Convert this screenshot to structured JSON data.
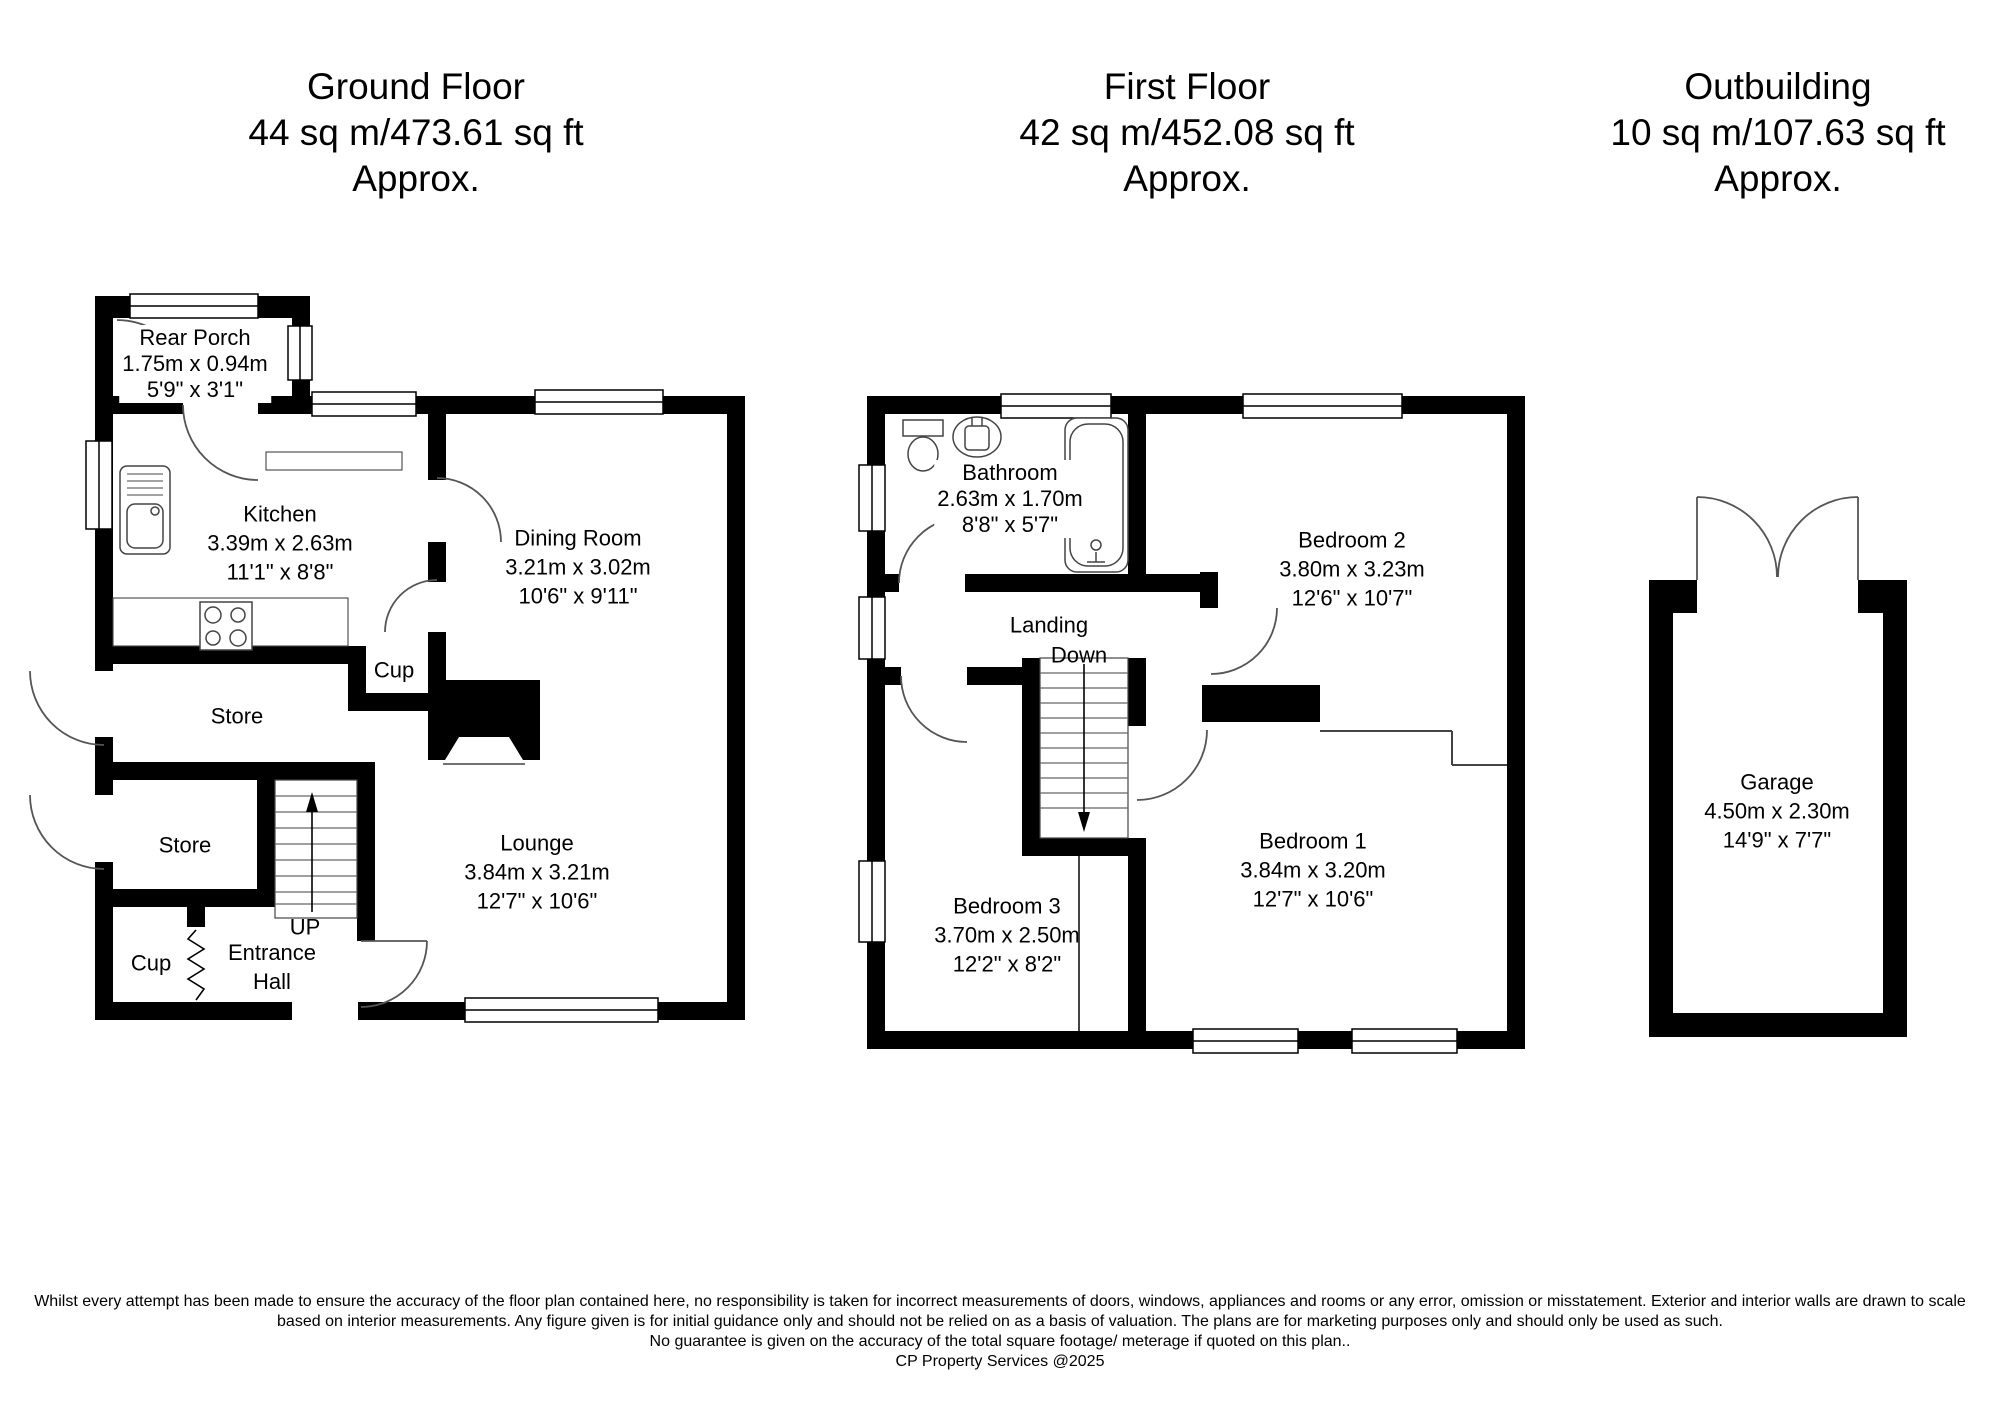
{
  "colors": {
    "background": "#ffffff",
    "wall": "#000000",
    "thin_line": "#444444",
    "text": "#000000"
  },
  "floors": [
    {
      "title": "Ground Floor",
      "area": "44 sq m/473.61 sq ft",
      "approx": "Approx.",
      "rooms": {
        "rear_porch": {
          "name": "Rear Porch",
          "metric": "1.75m x 0.94m",
          "imperial": "5'9\" x 3'1\""
        },
        "kitchen": {
          "name": "Kitchen",
          "metric": "3.39m x 2.63m",
          "imperial": "11'1\" x 8'8\""
        },
        "dining_room": {
          "name": "Dining Room",
          "metric": "3.21m x 3.02m",
          "imperial": "10'6\" x 9'11\""
        },
        "lounge": {
          "name": "Lounge",
          "metric": "3.84m x 3.21m",
          "imperial": "12'7\" x 10'6\""
        },
        "store_1": {
          "name": "Store"
        },
        "store_2": {
          "name": "Store"
        },
        "cup_upper": {
          "name": "Cup"
        },
        "cup_lower": {
          "name": "Cup"
        },
        "entrance_hall": {
          "name_line1": "Entrance",
          "name_line2": "Hall"
        },
        "stairs": {
          "label": "UP"
        }
      }
    },
    {
      "title": "First Floor",
      "area": "42 sq m/452.08 sq ft",
      "approx": "Approx.",
      "rooms": {
        "bathroom": {
          "name": "Bathroom",
          "metric": "2.63m x 1.70m",
          "imperial": "8'8\" x 5'7\""
        },
        "bedroom_1": {
          "name": "Bedroom 1",
          "metric": "3.84m x 3.20m",
          "imperial": "12'7\" x 10'6\""
        },
        "bedroom_2": {
          "name": "Bedroom 2",
          "metric": "3.80m x 3.23m",
          "imperial": "12'6\" x 10'7\""
        },
        "bedroom_3": {
          "name": "Bedroom 3",
          "metric": "3.70m x 2.50m",
          "imperial": "12'2\" x 8'2\""
        },
        "landing": {
          "name": "Landing"
        },
        "stairs": {
          "label": "Down"
        }
      }
    },
    {
      "title": "Outbuilding",
      "area": "10 sq m/107.63 sq ft",
      "approx": "Approx.",
      "rooms": {
        "garage": {
          "name": "Garage",
          "metric": "4.50m x 2.30m",
          "imperial": "14'9\" x 7'7\""
        }
      }
    }
  ],
  "footer": {
    "disclaimer_line1": "Whilst every attempt has been made to ensure the accuracy of the floor plan contained here, no responsibility is taken for incorrect measurements of doors, windows, appliances and rooms or any error, omission or misstatement. Exterior and interior walls are drawn to scale",
    "disclaimer_line2": "based on interior measurements. Any figure given is for initial guidance only and should not be relied on as a basis of valuation. The plans are for marketing purposes only and should only be used as such.",
    "disclaimer_line3": "No guarantee is given on the accuracy of the total square footage/ meterage if quoted on this plan..",
    "copyright": "CP Property Services @2025"
  }
}
